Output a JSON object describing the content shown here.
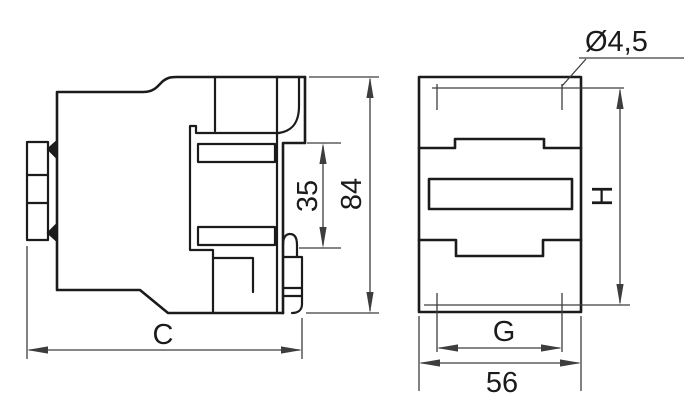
{
  "drawing": {
    "background": "#ffffff",
    "line_color": "#1b1b1b",
    "dim_line_color": "#3d3d3d",
    "side_view": {
      "width_label": "C",
      "height_label": "84",
      "rail_seat_label": "35"
    },
    "front_view": {
      "hole_diameter_label": "Ø4,5",
      "height_label": "H",
      "hole_spacing_label": "G",
      "width_label": "56"
    }
  }
}
